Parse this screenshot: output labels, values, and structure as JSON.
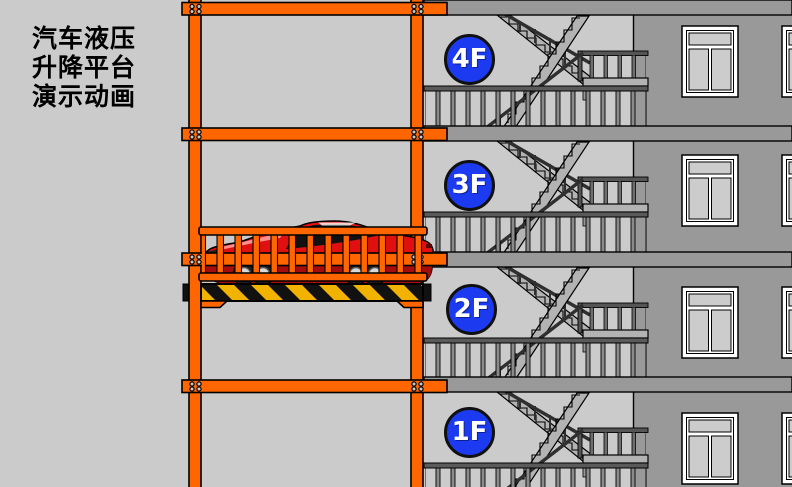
{
  "title": {
    "lines": [
      "汽车液压",
      "升降平台",
      "演示动画"
    ]
  },
  "floors": [
    {
      "label": "4F"
    },
    {
      "label": "3F"
    },
    {
      "label": "2F"
    },
    {
      "label": "1F"
    }
  ],
  "palette": {
    "orange": "#FF6600",
    "blue": "#1C3BF0",
    "bg": "#CBCBCB",
    "wall": "#999999",
    "stair": "#B3B3B3",
    "rail": "#555555",
    "raildark": "#2F2F2F",
    "pane": "#CCCCCC",
    "red": "#E01010",
    "reddark": "#A50D0D",
    "yellow": "#F2B200",
    "ink": "#111111"
  }
}
